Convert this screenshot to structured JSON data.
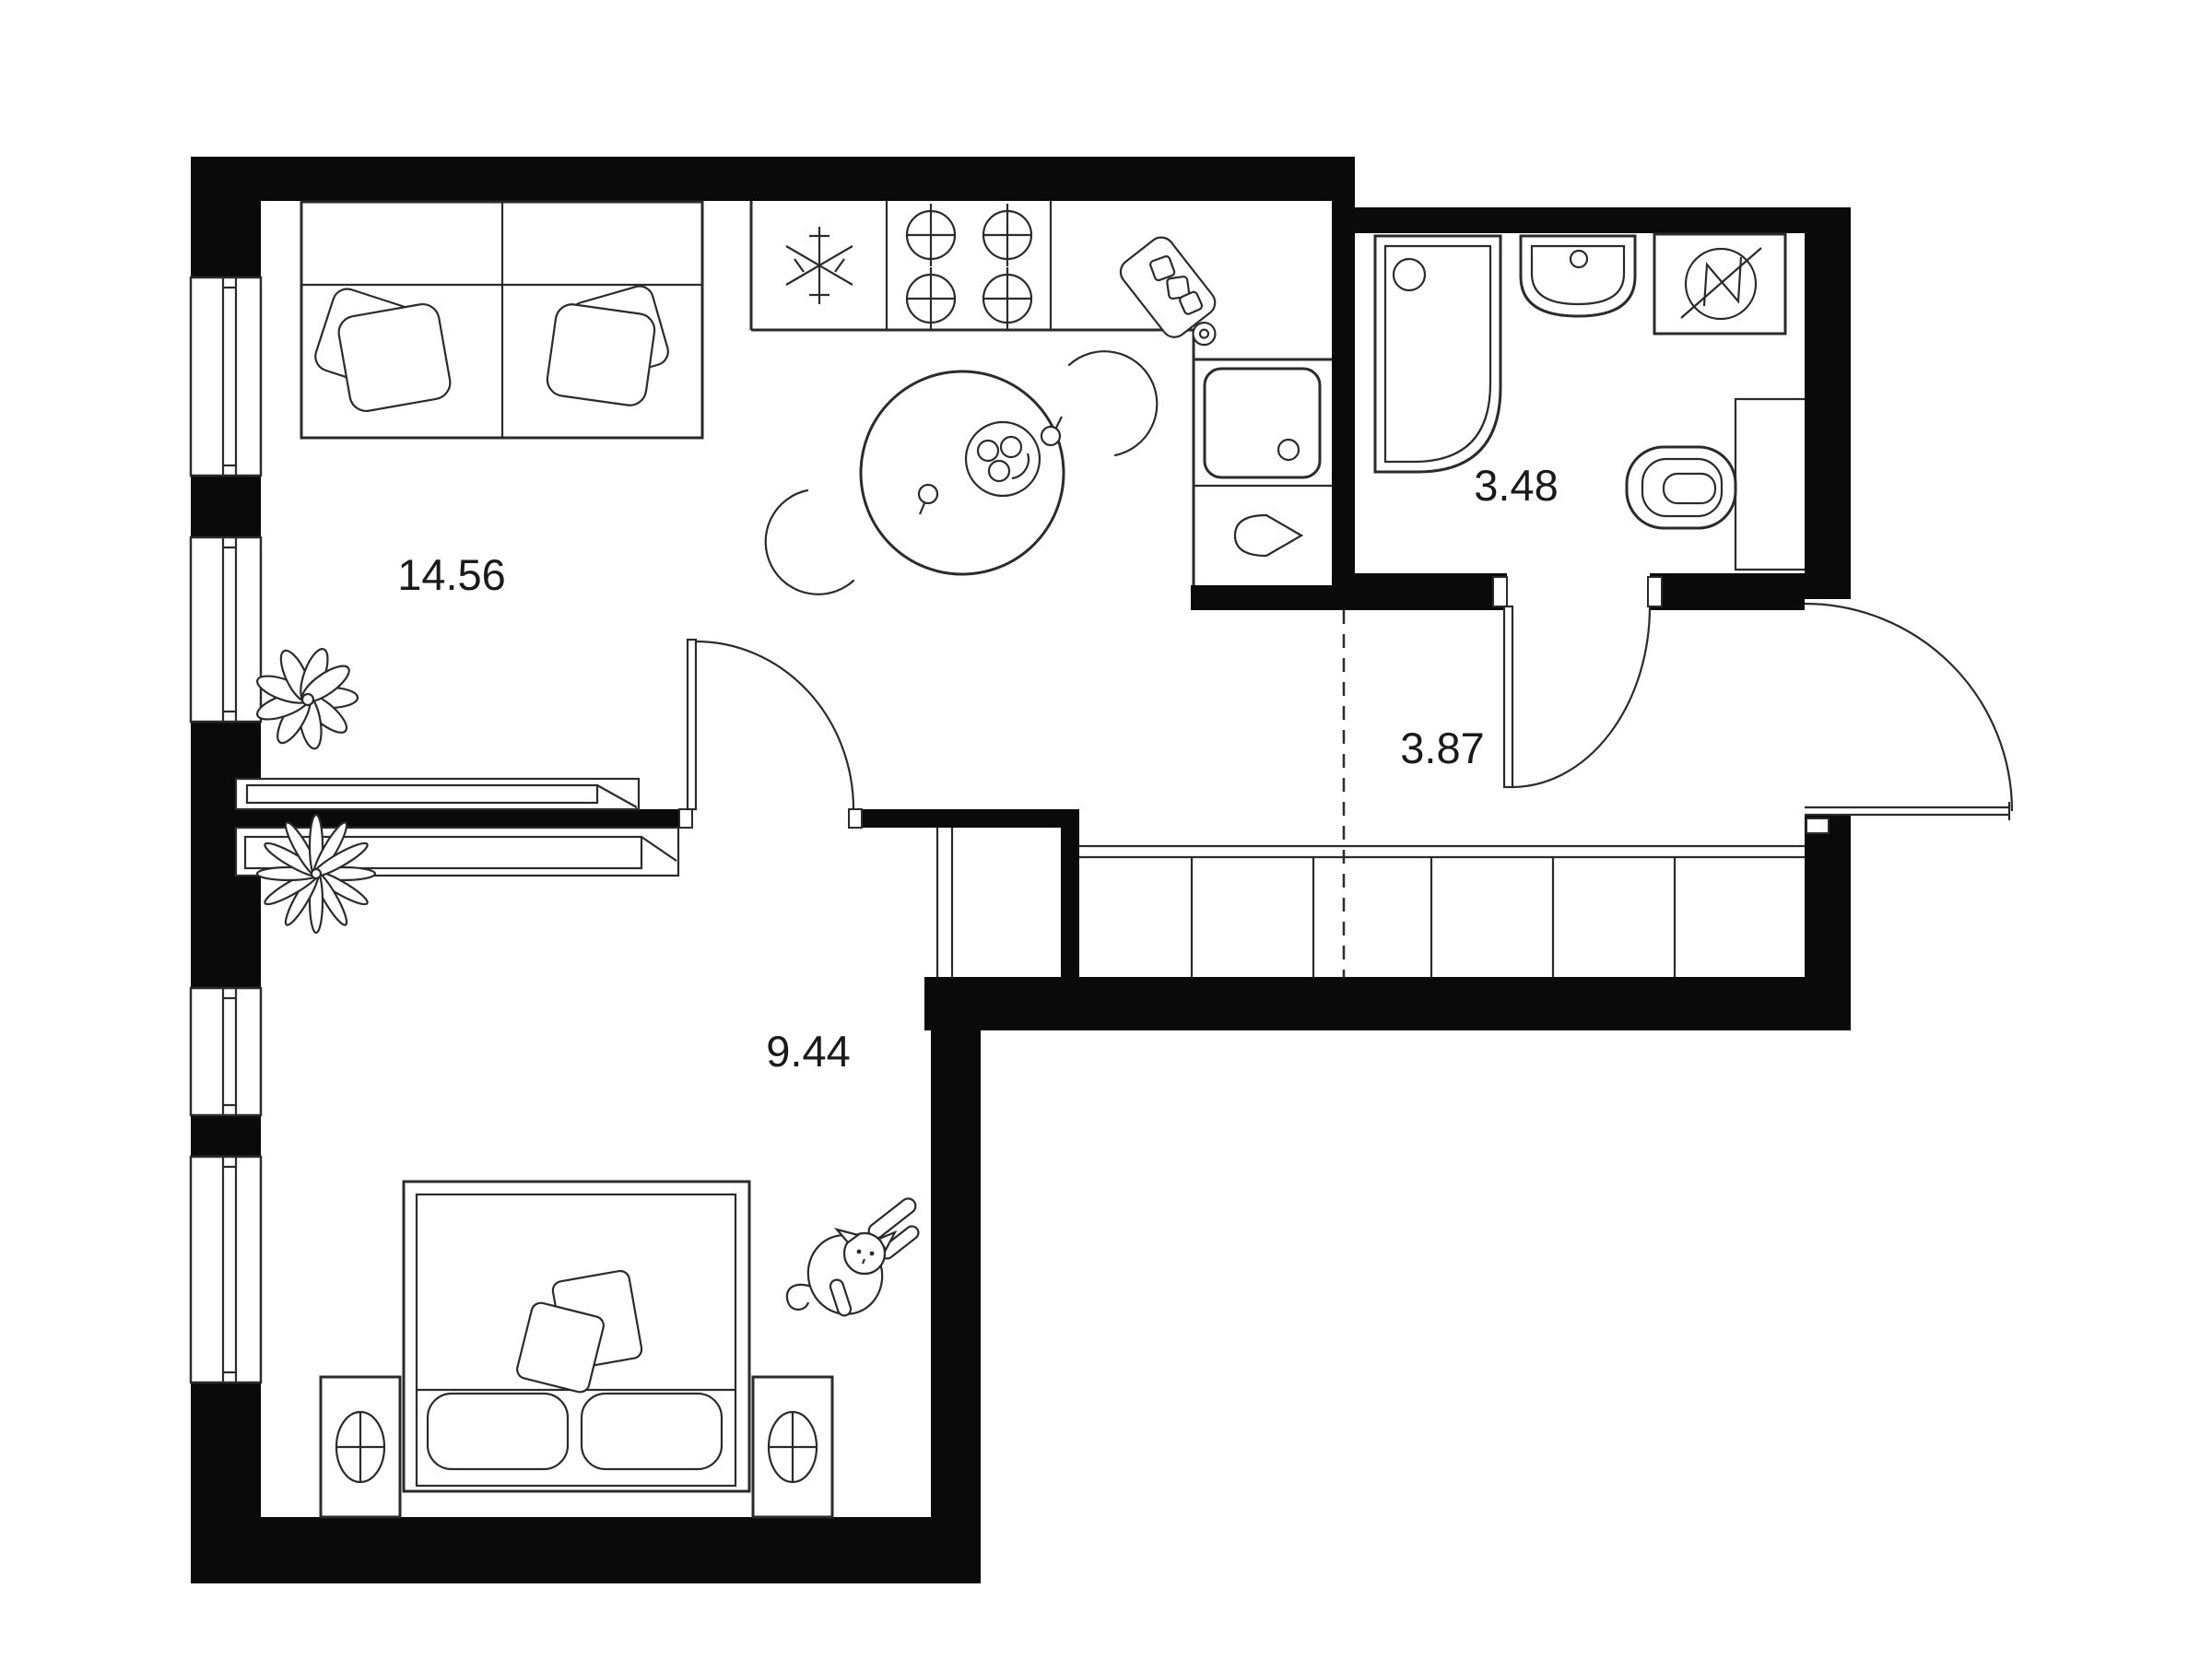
{
  "plan": {
    "type": "apartment-floor-plan",
    "units_note": "area values as printed on plan",
    "rooms": [
      {
        "name": "living-room-kitchen",
        "area": "14.56"
      },
      {
        "name": "bathroom",
        "area": "3.48"
      },
      {
        "name": "hallway",
        "area": "3.87"
      },
      {
        "name": "bedroom",
        "area": "9.44"
      }
    ],
    "fixtures": [
      "sofa-with-pillows",
      "fridge-snowflake-icon",
      "stove-burners-icon",
      "cutting-board-icon",
      "kitchen-sink",
      "dining-table-with-chairs",
      "shower-cabin",
      "wash-basin",
      "washing-machine-icon",
      "toilet",
      "entrance-door-arc",
      "bathroom-door-arc",
      "bedroom-door-arc",
      "wardrobe-cells",
      "double-bed",
      "nightstand-left",
      "nightstand-right",
      "tv-console",
      "plant-icon-living",
      "plant-icon-bedroom",
      "cat-icon",
      "windows-left-wall",
      "zone-divider-dashed-line"
    ],
    "colors": {
      "background": "#ffffff",
      "walls": "#0a0a0a",
      "lines": "#2b2b2b",
      "text": "#1a1a1a"
    }
  }
}
